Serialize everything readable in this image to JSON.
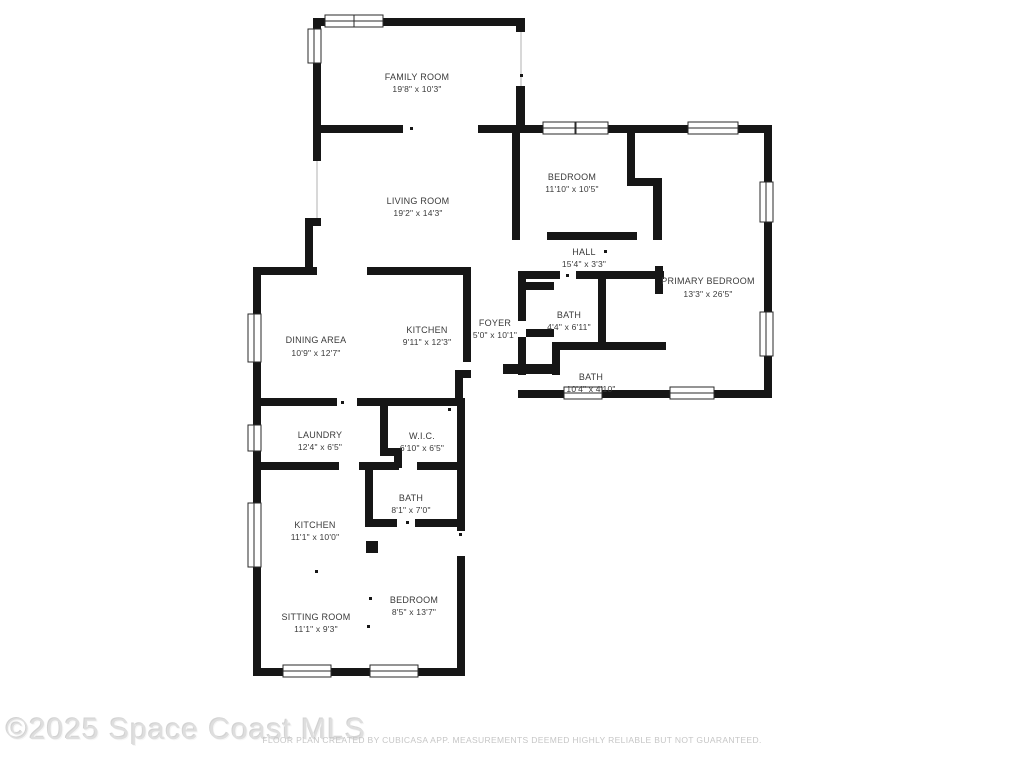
{
  "floor_plan": {
    "rooms": [
      {
        "name": "FAMILY ROOM",
        "dims": "19'8\" x 10'3\""
      },
      {
        "name": "LIVING ROOM",
        "dims": "19'2\" x 14'3\""
      },
      {
        "name": "BEDROOM",
        "dims": "11'10\" x 10'5\""
      },
      {
        "name": "HALL",
        "dims": "15'4\" x 3'3\""
      },
      {
        "name": "PRIMARY BEDROOM",
        "dims": "13'3\" x 26'5\""
      },
      {
        "name": "DINING AREA",
        "dims": "10'9\" x 12'7\""
      },
      {
        "name": "KITCHEN",
        "dims": "9'11\" x 12'3\""
      },
      {
        "name": "FOYER",
        "dims": "5'0\" x 10'1\""
      },
      {
        "name": "BATH",
        "dims": "4'4\" x 6'11\""
      },
      {
        "name": "BATH",
        "dims": "10'4\" x 4'10\""
      },
      {
        "name": "LAUNDRY",
        "dims": "12'4\" x 6'5\""
      },
      {
        "name": "W.I.C.",
        "dims": "6'10\" x 6'5\""
      },
      {
        "name": "BATH",
        "dims": "8'1\" x 7'0\""
      },
      {
        "name": "KITCHEN",
        "dims": "11'1\" x 10'0\""
      },
      {
        "name": "SITTING ROOM",
        "dims": "11'1\" x 9'3\""
      },
      {
        "name": "BEDROOM",
        "dims": "8'5\" x 13'7\""
      }
    ],
    "watermark": "©2025 Space Coast MLS",
    "disclaimer": "FLOOR PLAN CREATED BY CUBICASA APP. MEASUREMENTS DEEMED HIGHLY RELIABLE BUT NOT GUARANTEED.",
    "wall_color": "#161616",
    "background": "#ffffff"
  }
}
